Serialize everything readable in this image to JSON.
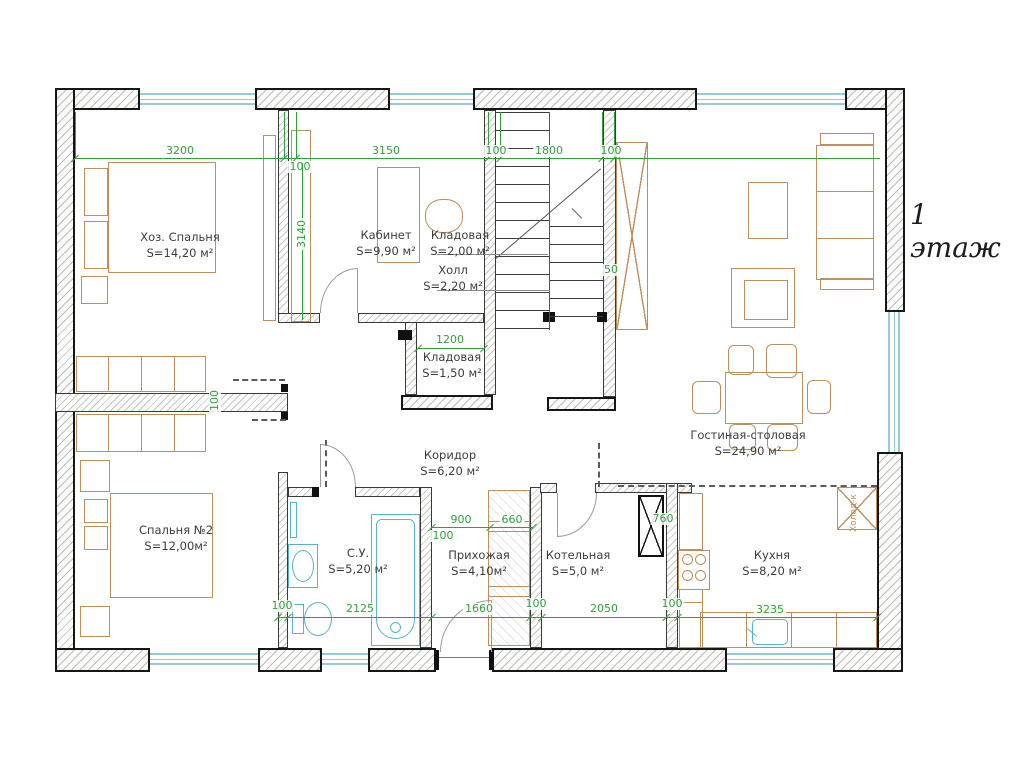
{
  "floor_label": "1 этаж",
  "rooms": [
    {
      "name": "Хоз. Спальня",
      "area": "S=14,20 м²"
    },
    {
      "name": "Кабинет",
      "area": "S=9,90 м²"
    },
    {
      "name": "Кладовая",
      "area": "S=2,00 м²"
    },
    {
      "name": "Холл",
      "area": "S=2,20 м²"
    },
    {
      "name": "Кладовая",
      "area": "S=1,50 м²"
    },
    {
      "name": "Гостиная-столовая",
      "area": "S=24,90 м²"
    },
    {
      "name": "Спальня №2",
      "area": "S=12,00м²"
    },
    {
      "name": "Коридор",
      "area": "S=6,20 м²"
    },
    {
      "name": "С.У.",
      "area": "S=5,20 м²"
    },
    {
      "name": "Прихожая",
      "area": "S=4,10м²"
    },
    {
      "name": "Котельная",
      "area": "S=5,0 м²"
    },
    {
      "name": "Кухня",
      "area": "S=8,20 м²"
    }
  ],
  "dimensions": {
    "top_row": [
      "3200",
      "100",
      "3150",
      "100",
      "1800",
      "100"
    ],
    "left_wall_vertical": "3140",
    "stair_side": "50",
    "pantry_width": "1200",
    "bedroom_wall": "100",
    "hall_door": "900",
    "hall_closet": "660",
    "hall_wall": "100",
    "boiler_shaft": "760",
    "bottom_row": [
      "100",
      "2125",
      "1660",
      "100",
      "2050",
      "100",
      "3235"
    ]
  },
  "annotations": {
    "fridge": "Холод-к"
  },
  "colors": {
    "dimension": "#2fa13b",
    "window": "#93ccd6",
    "furniture": "#bd9059",
    "fixture": "#55b5c8",
    "wall_outline": "#161616"
  }
}
